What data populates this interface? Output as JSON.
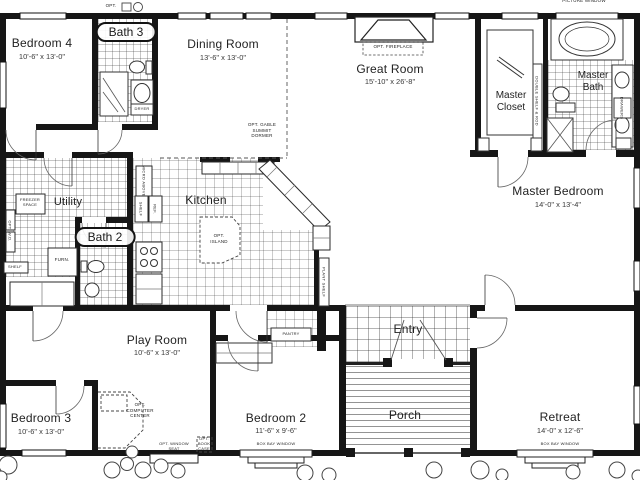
{
  "plan": {
    "rooms": {
      "bedroom4": {
        "name": "Bedroom 4",
        "dims": "10'-6\" x 13'-0\""
      },
      "bath3": {
        "name": "Bath 3"
      },
      "dining": {
        "name": "Dining Room",
        "dims": "13'-6\" x 13'-0\""
      },
      "great": {
        "name": "Great Room",
        "dims": "15'-10\" x 26'-8\""
      },
      "master_closet": {
        "name": "Master Closet"
      },
      "master_bath": {
        "name": "Master Bath"
      },
      "utility": {
        "name": "Utility"
      },
      "bath2": {
        "name": "Bath 2"
      },
      "kitchen": {
        "name": "Kitchen"
      },
      "playroom": {
        "name": "Play Room",
        "dims": "10'-6\" x 13'-0\""
      },
      "entry": {
        "name": "Entry"
      },
      "porch": {
        "name": "Porch"
      },
      "master_bedroom": {
        "name": "Master Bedroom",
        "dims": "14'-0\" x 13'-4\""
      },
      "retreat": {
        "name": "Retreat",
        "dims": "14'-0\" x 12'-6\""
      },
      "bedroom2": {
        "name": "Bedroom 2",
        "dims": "11'-6\" x 9'-6\""
      },
      "bedroom3": {
        "name": "Bedroom 3",
        "dims": "10'-6\" x 13'-0\""
      }
    },
    "annotations": {
      "opt_fireplace": "OPT. FIREPLACE",
      "opt_dormer": "OPT. GABLE SUMMIT DORMER",
      "opt_island": "OPT. ISLAND",
      "freezer": "FREEZER SPACE",
      "furn": "FURN.",
      "shelf": "SHELF",
      "shelf2": "SHELF",
      "ref": "REF.",
      "micro": "MICRO ABOVE",
      "pantry": "PANTRY",
      "plant_shelf": "PLANT SHELF",
      "double_rod": "DOUBLE SHELF & ROD",
      "opt_computer": "OPT. COMPUTER CENTER",
      "opt_window_seat": "OPT. WINDOW SEAT",
      "opt_book_case": "OPT. BOOK CASE",
      "box_bay2": "BOX BAY WINDOW",
      "box_bay_retreat": "BOX BAY WINDOW",
      "picture_window": "PICTURE WINDOW",
      "dryer": "DRYER",
      "wd_stack": "OPT. W.D.",
      "drawers": "DRAWERS",
      "opt_top": "OPT."
    },
    "colors": {
      "wall": "#161616",
      "line": "#444444",
      "text": "#222222"
    }
  }
}
